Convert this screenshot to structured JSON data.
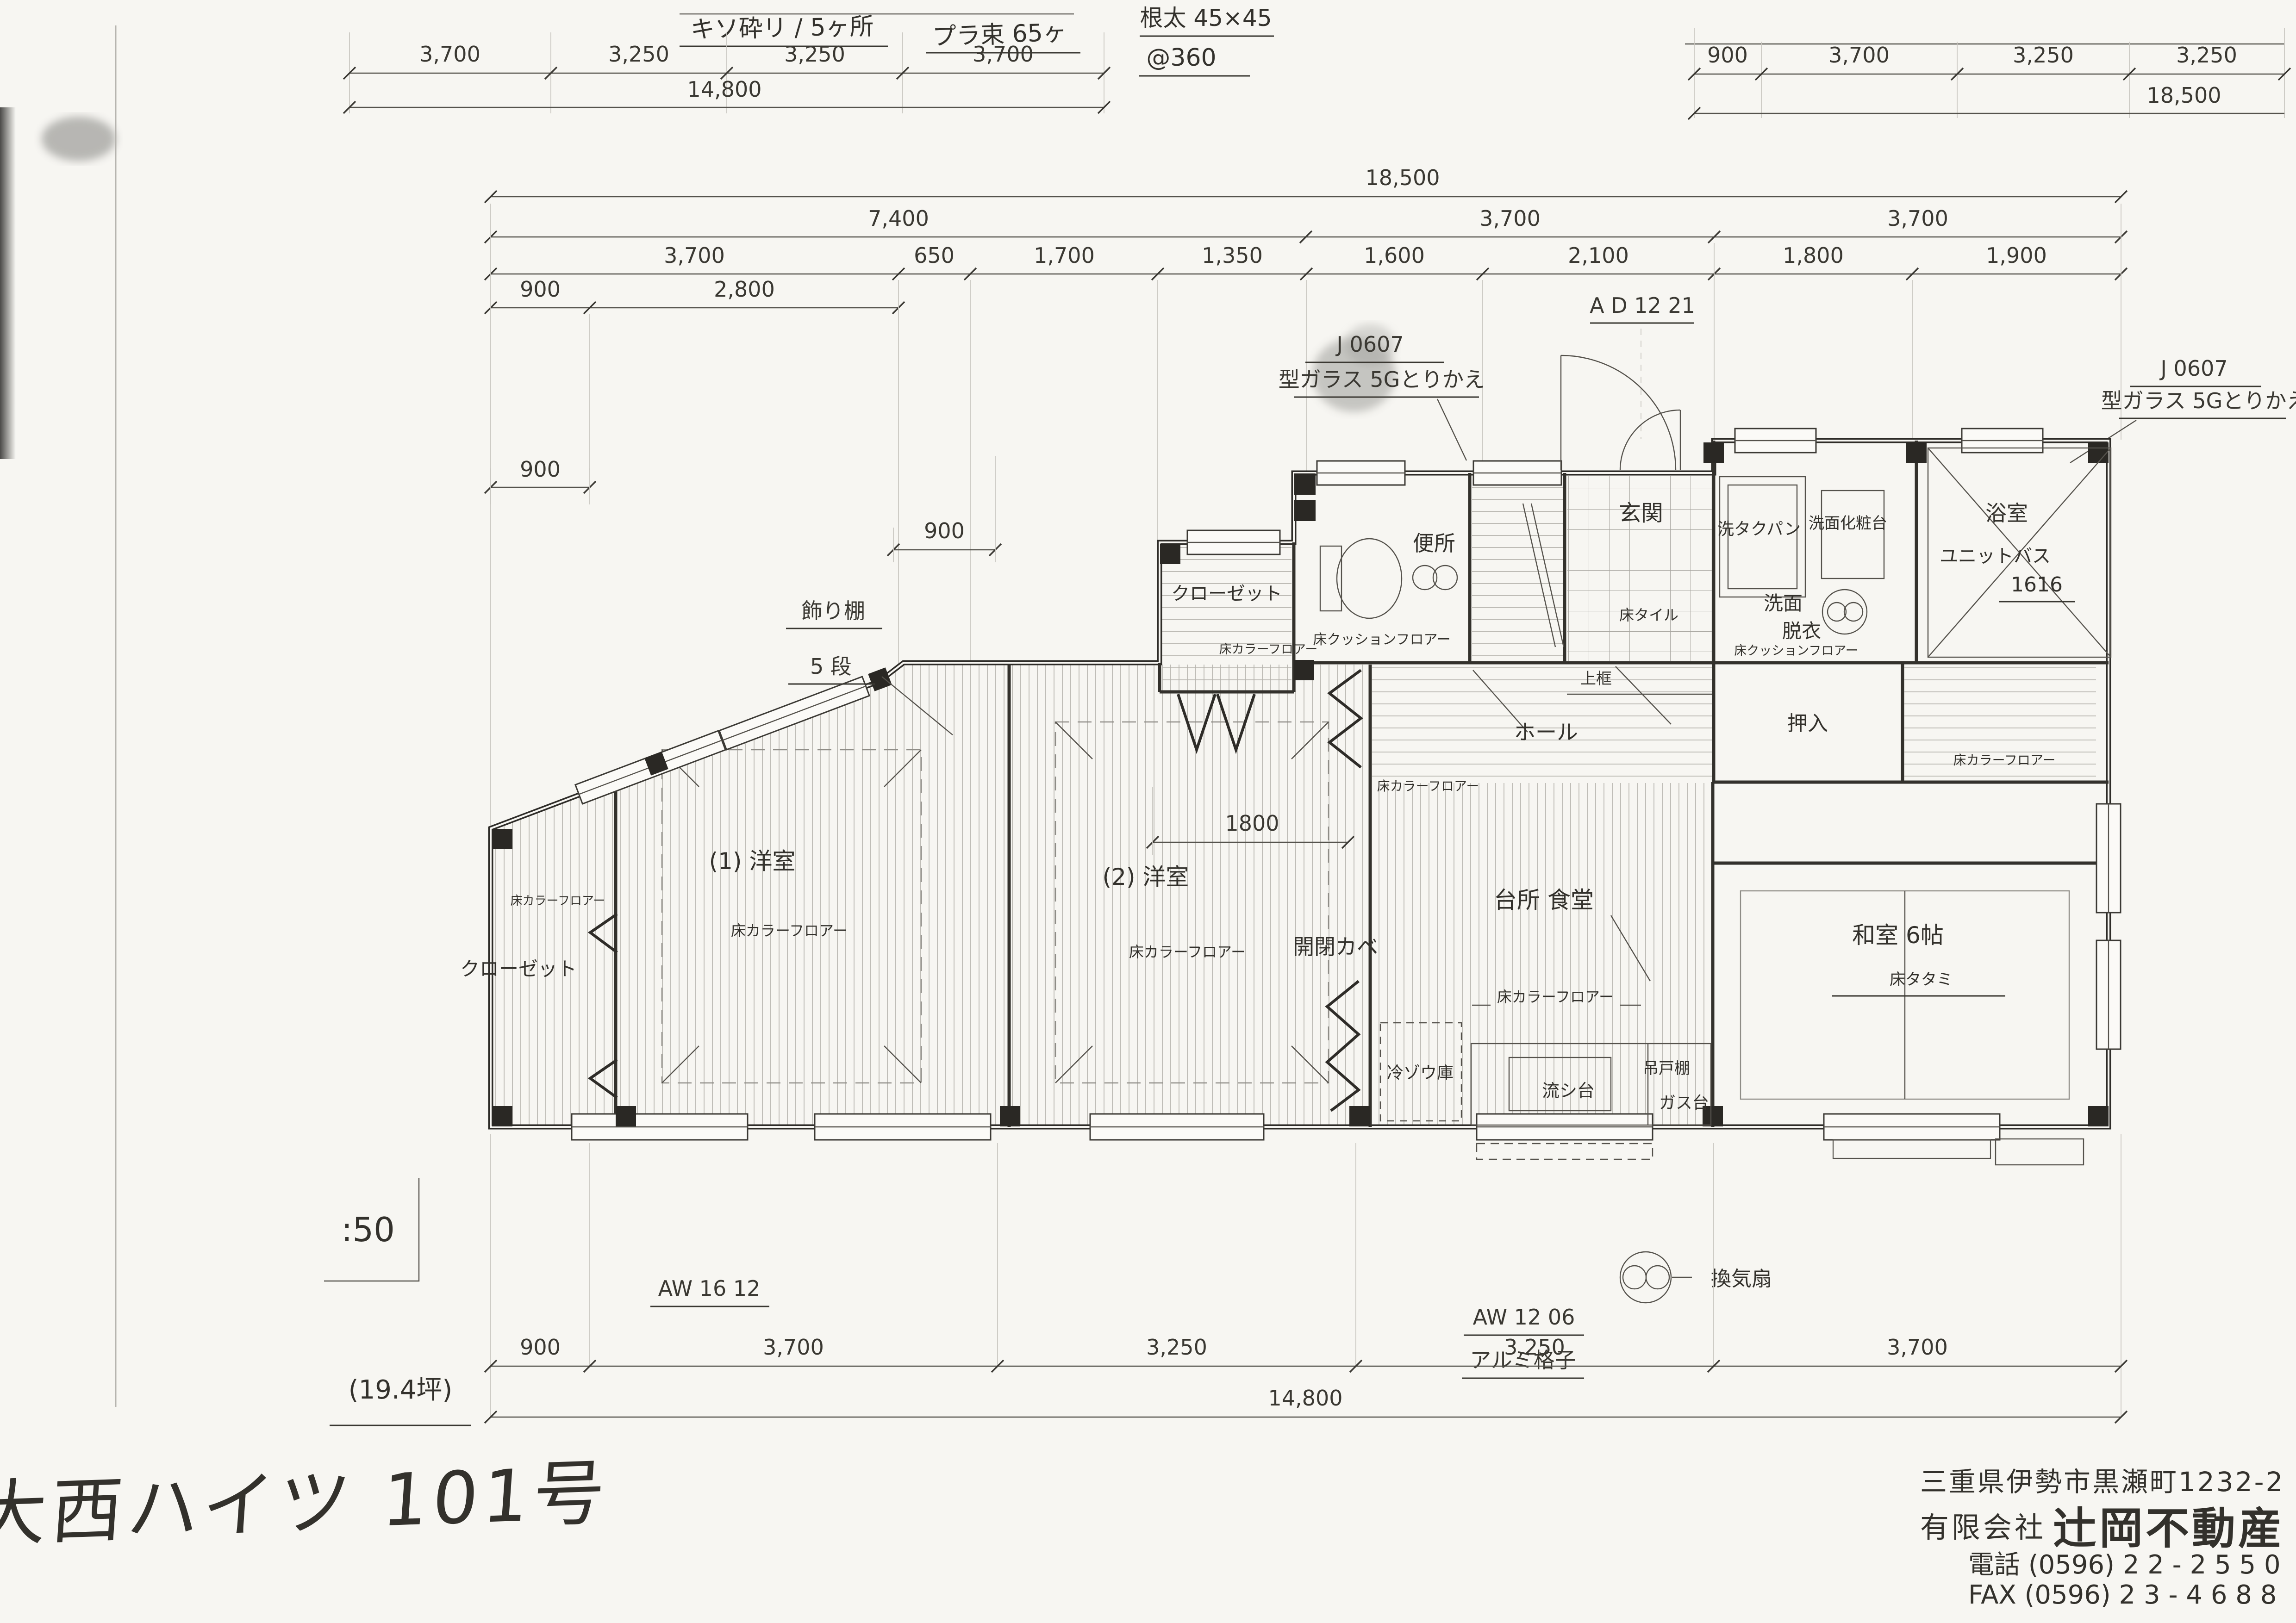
{
  "handwritten": {
    "title": "大西ハイツ 101号",
    "foundation": "キソ砕リ / 5ヶ所",
    "posts": "プラ束 65ヶ",
    "joist": "根太 45×45",
    "pitch": "@360"
  },
  "glass_note": {
    "code": "J 0607",
    "text": "型ガラス 5Gとりかえ"
  },
  "shelf_note": {
    "line1": "飾り棚",
    "line2": "5 段"
  },
  "floor_labels": {
    "color": "床カラーフロアー",
    "cushion": "床クッションフロアー",
    "tile": "床タイル",
    "tatami": "床タタミ"
  },
  "rooms": {
    "toilet": "便所",
    "entrance": "玄関",
    "agarikamachi": "上框",
    "hall": "ホール",
    "closet": "クローゼット",
    "washroom1": "洗面",
    "washroom2": "脱衣",
    "laundry_pan": "洗タクパン",
    "vanity": "洗面化粧台",
    "bath": "浴室",
    "bath_type": "ユニットバス",
    "bath_size": "1616",
    "oshiire": "押入",
    "western1": "(1) 洋室",
    "western2": "(2) 洋室",
    "kitchen": "台所  食堂",
    "partition": "開閉カベ",
    "fridge": "冷ゾウ庫",
    "hanging_shelf": "吊戸棚",
    "sink": "流シ台",
    "gas": "ガス台",
    "fan": "換気扇",
    "washitsu": "和室 6帖"
  },
  "openings": {
    "door_code": "A D 12 21",
    "window_aw1612": "AW 16 12",
    "window_aw1206": "AW 12 06",
    "grille": "アルミ格子"
  },
  "dims": {
    "aux_left": [
      "3,700",
      "3,250",
      "3,250",
      "3,700"
    ],
    "aux_left_total": "14,800",
    "aux_right": [
      "900",
      "3,700",
      "3,250",
      "3,250"
    ],
    "aux_right_total": "18,500",
    "total": "18,500",
    "row2": [
      "7,400",
      "3,700",
      "3,700"
    ],
    "row3": [
      "3,700",
      "650",
      "1,700",
      "1,350",
      "1,600",
      "2,100",
      "1,800",
      "1,900"
    ],
    "row4": [
      "900",
      "2,800"
    ],
    "d900a": "900",
    "d900b": "900",
    "d1800": "1800",
    "bottom": [
      "900",
      "3,700",
      "3,250",
      "3,250",
      "3,700"
    ],
    "bottom_total": "14,800"
  },
  "title_block": {
    "scale": ":50",
    "area": "(19.4坪)"
  },
  "stamp": {
    "address": "三重県伊勢市黒瀬町1232-2",
    "company_prefix": "有限会社",
    "company_name": "辻岡不動産",
    "tel": "電話 (0596) 2 2 - 2 5 5 0",
    "fax": "FAX (0596) 2 3 - 4 6 8 8"
  }
}
